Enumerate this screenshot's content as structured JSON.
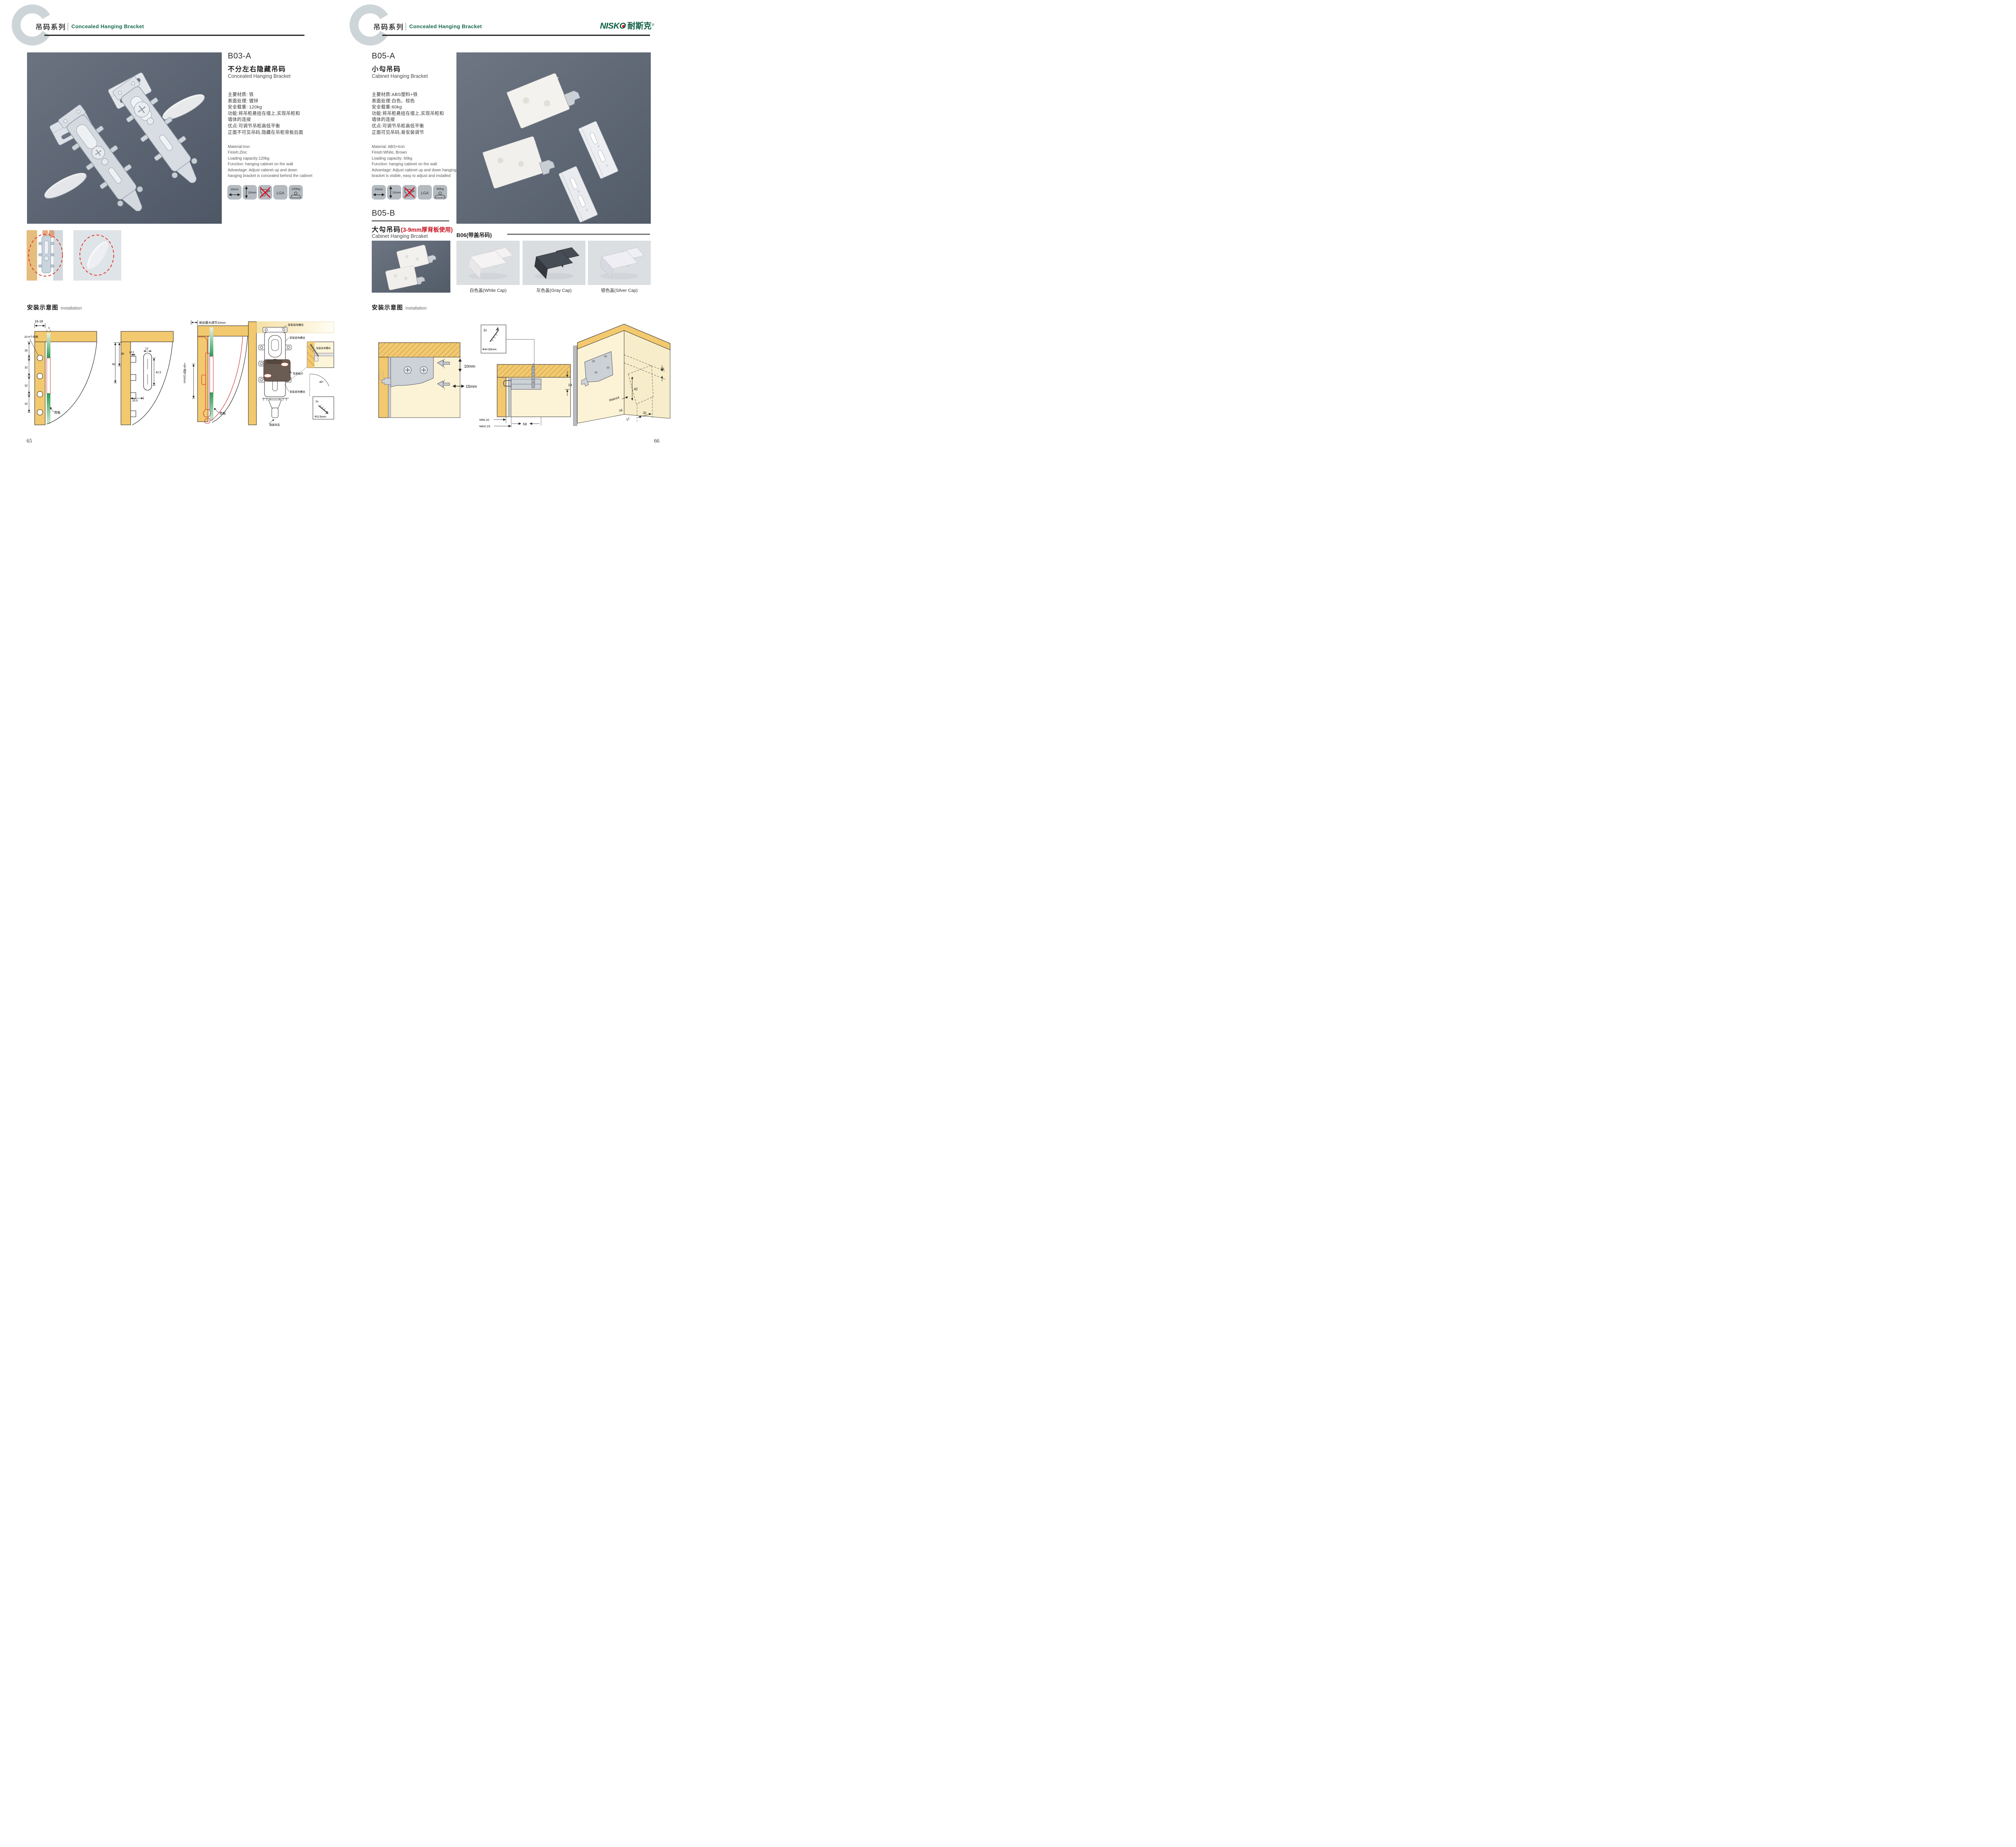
{
  "colors": {
    "accent_green": "#156a4a",
    "logo_green": "#0c5f43",
    "red": "#c81420",
    "icon_tile_bg": "#b3bac0",
    "wood": "#f3c96f",
    "photo_slate": "#5d6673",
    "cream": "#fcf3d6"
  },
  "brand": {
    "logo_en": "NISKO",
    "logo_cn": "耐斯克",
    "registered": "®"
  },
  "header": {
    "series_cn": "吊码系列",
    "series_en": "Concealed Hanging Bracket"
  },
  "installation_title": {
    "cn": "安装示意图",
    "en": "Installation"
  },
  "left": {
    "page_number": "65",
    "product": {
      "code": "B03-A",
      "name_cn": "不分左右隐藏吊码",
      "name_en": "Concealed Hanging Bracket",
      "specs_cn": [
        "主要材质: 铁",
        "表面处理: 镀锌",
        "安全载重: 120kg",
        "功能:将吊柜悬挂在墙上,实现吊柜和",
        "墙体的连接",
        "优点:可调节吊柜高低平衡",
        "正面不可见吊码,隐藏在吊柜背板后面"
      ],
      "specs_en": [
        "Material:Iron",
        "Finish:Zinc",
        "Loading capacity:120kg",
        "Function: hanging cabinet on the wall",
        "Advantage: Adjust cabinet up and down",
        "hanging bracket is concealed behind the cabinet"
      ],
      "icons": {
        "width": "10mm",
        "height": "10mm",
        "cert": "LGA",
        "load": "120Kg"
      }
    },
    "diagrams": {
      "d1": {
        "dim_top": "16-18",
        "dim_small": "5",
        "dim_a": "35",
        "dim_b": "32",
        "dim_c": "32",
        "dim_d": "32",
        "holes_label": "10-4个均布",
        "back_label": "背板"
      },
      "d2": {
        "dim_60": "60",
        "dim_35": "35",
        "dim_125": "12.5",
        "dim_12": "12",
        "dim_425": "42.5",
        "dim_205": "20.5"
      },
      "d3": {
        "top_label": "前后最大调节10mm",
        "side_label": "上下调节10mm",
        "back_label": "背板"
      },
      "d4": {
        "screw_label_1": "安装自攻螺丝",
        "screw_label_2": "安装自攻螺丝",
        "screw_label_3": "安装自攻螺丝",
        "hanger_label": "专用挂片",
        "lock_label": "锁紧状态",
        "inset_label": "安装自攻螺丝",
        "angle": "45°",
        "qty": "1x",
        "size": "Φ3.5mm"
      }
    }
  },
  "right": {
    "page_number": "66",
    "product_a": {
      "code": "B05-A",
      "name_cn": "小勾吊码",
      "name_en": "Cabinet Hanging Bracket",
      "specs_cn": [
        "主要材质:ABS塑料+铁",
        "表面处理:白色、棕色",
        "安全载重:60kg",
        "功能:将吊柜悬挂在墙上,实现吊柜和",
        "墙体的连接",
        "优点:可调节吊柜高低平衡",
        "正面可见吊码,易安装调节"
      ],
      "specs_en": [
        "Material: ABS+Iron",
        "Finish:White, Brown",
        "Loading capacity: 60kg",
        "Function: hanging cabinet on the wall",
        "Advantage: Adjust cabinet up and down hanging",
        "bracket is visible, easy to adjust and installed"
      ],
      "icons": {
        "width": "15mm",
        "height": "10mm",
        "cert": "LGA",
        "load": "60Kg"
      }
    },
    "product_b": {
      "code": "B05-B",
      "name_cn": "大勾吊码",
      "note": "(3-9mm厚背板使用)",
      "name_en": "Cabinet Hanging Brcaket"
    },
    "b06": {
      "title": "B06(带盖吊码)",
      "caps": [
        "白色盖(White Cap)",
        "灰色盖(Gray Cap)",
        "银色盖(Silver Cap)"
      ]
    },
    "diagrams": {
      "r1": {
        "v": "10mm",
        "h": "15mm"
      },
      "r2": {
        "qty": "2x",
        "size": "Φ4×30mm",
        "dim_18": "18",
        "dim_min": "MIN.10",
        "dim_max": "MAX.23",
        "dim_58": "58"
      },
      "r3": {
        "d16a": "16",
        "d42": "42",
        "rmax": "RMAX4",
        "d16b": "16",
        "d17": "17",
        "d32": "32"
      }
    }
  }
}
